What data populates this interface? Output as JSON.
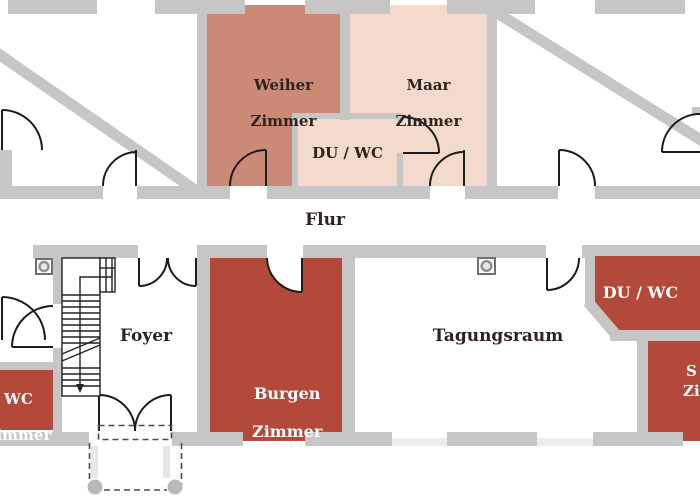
{
  "floorplan": {
    "corridor": {
      "label": "Flur"
    },
    "rooms": {
      "weiher": {
        "line1": "Weiher",
        "line2": "Zimmer",
        "color": "#cb8a76"
      },
      "maar": {
        "line1": "Maar",
        "line2": "Zimmer",
        "color": "#f4dacd"
      },
      "duwc_top": {
        "label": "DU / WC",
        "color": "#f4dacd"
      },
      "foyer": {
        "label": "Foyer",
        "color": "#ffffff"
      },
      "burgen": {
        "line1": "Burgen",
        "line2": "Zimmer",
        "color": "#b2493b"
      },
      "tagungsraum": {
        "label": "Tagungsraum",
        "color": "#ffffff"
      },
      "duwc_right": {
        "label": "DU / WC",
        "color": "#b2493b"
      },
      "left_partial": {
        "line1": "WC",
        "line2": "Zimmer",
        "color": "#b2493b"
      },
      "right_partial": {
        "line1": "S",
        "line2": "Zi",
        "color": "#b2493b"
      }
    },
    "symbols": {
      "pillar": "square-with-circle",
      "stair_direction": "down-arrow",
      "entrance": "double-swing-doors"
    },
    "colors": {
      "wall_gray": "#c6c6c7",
      "room_dark_red": "#b2493b",
      "room_salmon": "#cb8a76",
      "room_pink": "#f4dacd",
      "line_black": "#1c1c1c",
      "text_dark": "#2f2320",
      "text_light": "#ffffff",
      "sill_light": "#ededed",
      "porch_gray": "#b9b9b9"
    }
  }
}
